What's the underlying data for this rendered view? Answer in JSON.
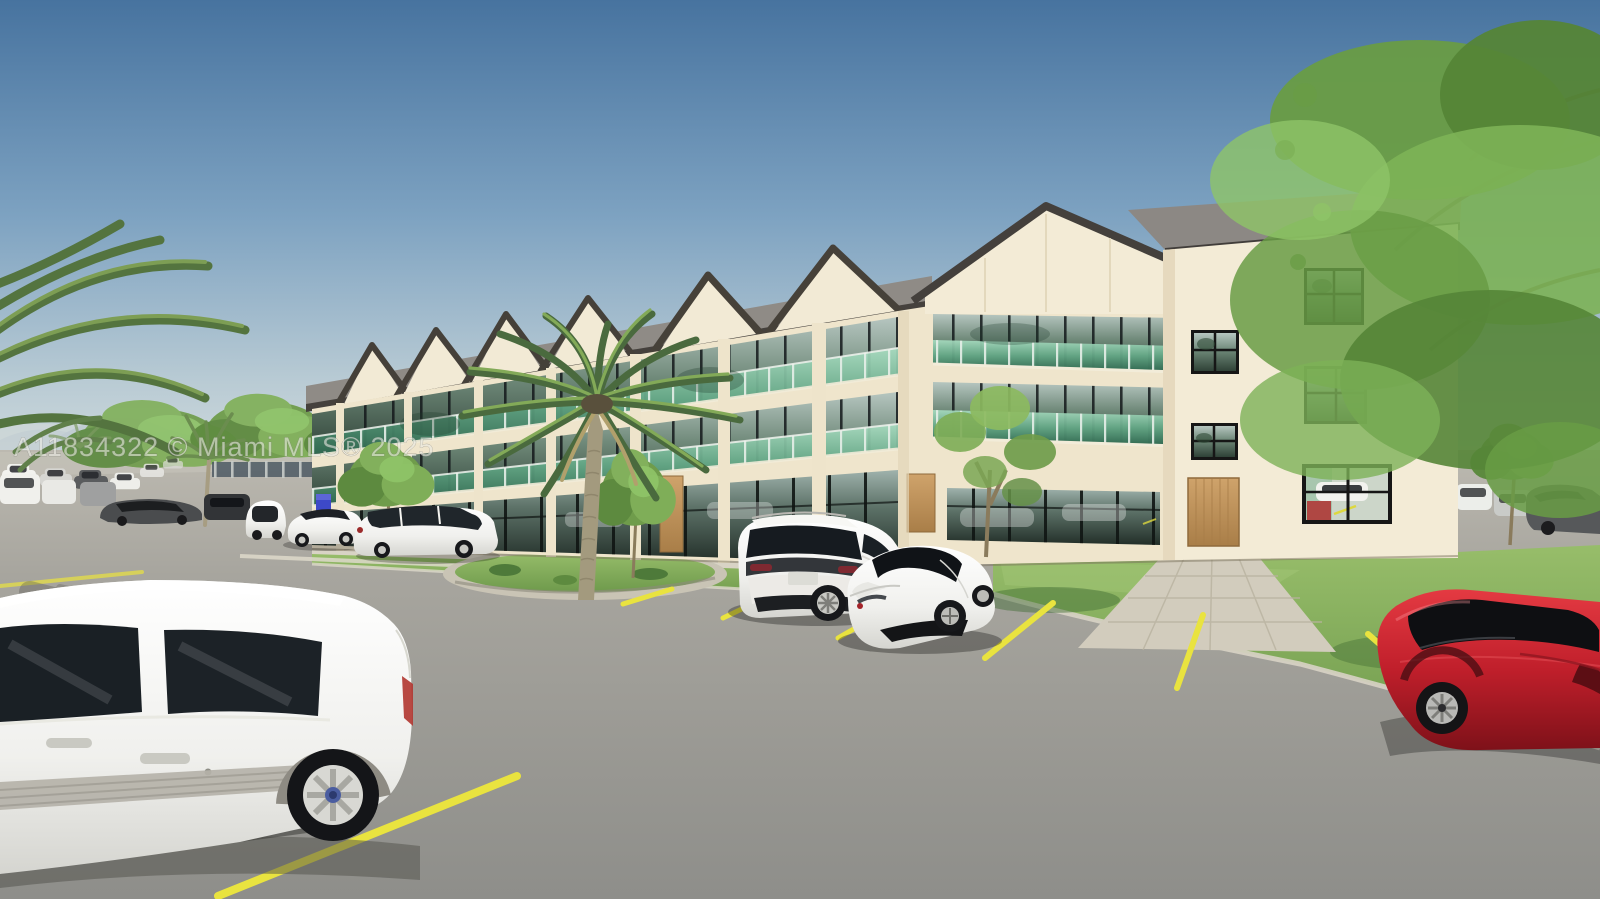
{
  "meta": {
    "image_type": "3D architectural rendering (exterior real-estate listing photo)",
    "width_px": 1600,
    "height_px": 899
  },
  "watermark": {
    "text": "A11834322 © Miami MLS® 2025",
    "listing_id": "A11834322",
    "source": "Miami MLS®",
    "year": "2025",
    "color": "#e9e9e3"
  },
  "scene": {
    "description": "Three-story cream stucco condo building with seven gabled roof sections, glass juliet balconies with green glass, black-framed storefront glazing on ground floor, wood entry doors, landscaped parking lot with yellow angled stalls, palm trees and young shade trees, parked cars in fore/background under a clear blue sky",
    "sky": {
      "top": "#47739f",
      "horizon": "#d3dcde"
    },
    "building": {
      "floors": 3,
      "gable_sections": 7,
      "wall_color": "#efe5cc",
      "gable_face_color": "#f2ead5",
      "roof_color": "#45413d",
      "roof_plane_color": "#8f8b86",
      "window_frame_color": "#161616",
      "balcony_glass_color": "#63a886",
      "door_wood_color": "#c59a63"
    },
    "ground": {
      "asphalt_color": "#979792",
      "parking_line_color": "#e9e33f",
      "grass_color": "#7fa85a",
      "sidewalk_color": "#d2ccbd"
    },
    "vehicles": [
      {
        "type": "cargo van (foreground left)",
        "color": "white"
      },
      {
        "type": "midsize SUV (center stalls)",
        "color": "white"
      },
      {
        "type": "sports coupe (center stalls)",
        "color": "white"
      },
      {
        "type": "sedan (bottom right, cropped)",
        "color": "red"
      },
      {
        "type": "compact hatchback (by building)",
        "color": "white"
      },
      {
        "type": "low sedan (by building)",
        "color": "white"
      },
      {
        "type": "compact SUV (by building)",
        "color": "white"
      },
      {
        "type": "coupe (background left)",
        "color": "dark gray"
      },
      {
        "type": "parked row (far left distance)",
        "color": "white / gray / black"
      },
      {
        "type": "parked row (far right distance)",
        "color": "white / silver / dark gray"
      }
    ],
    "vegetation": {
      "palms": "large canary palm center-front, palm fronds overhanging top-left corner, small background palms",
      "trees": "young deciduous trees along facade and lawns, large green canopy overhanging from the right"
    }
  }
}
